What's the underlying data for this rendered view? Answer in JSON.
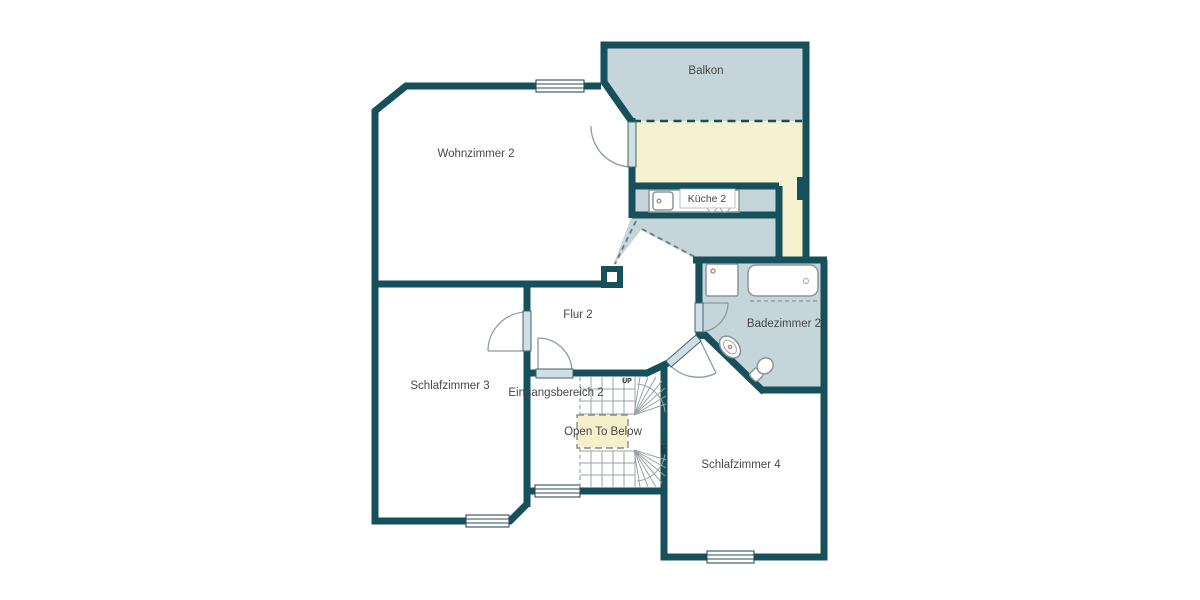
{
  "floorplan": {
    "rooms": [
      {
        "id": "balkon",
        "label": "Balkon"
      },
      {
        "id": "wohnzimmer-2",
        "label": "Wohnzimmer 2"
      },
      {
        "id": "kueche-2",
        "label": "Küche 2"
      },
      {
        "id": "flur-2",
        "label": "Flur 2"
      },
      {
        "id": "schlafzimmer-3",
        "label": "Schlafzimmer 3"
      },
      {
        "id": "eingangsbereich-2",
        "label": "Eingangsbereich 2"
      },
      {
        "id": "badezimmer-2",
        "label": "Badezimmer 2"
      },
      {
        "id": "schlafzimmer-4",
        "label": "Schlafzimmer 4"
      }
    ],
    "stairs": {
      "up_label_top": "UP",
      "up_label_bottom": "UP",
      "open_to_below_label": "Open To Below"
    },
    "fixtures": [
      "shower",
      "bathtub",
      "washbasin",
      "toilet",
      "kitchen-sink",
      "stove-burners"
    ],
    "colors": {
      "wall": "#16505a",
      "room_tint": "#c6d5da",
      "kitchen_floor": "#f6f1ce",
      "open_to_below_fill": "#f6efc9",
      "door_leaf": "#cfdfe4",
      "label_text": "#474747",
      "background": "#ffffff"
    }
  }
}
